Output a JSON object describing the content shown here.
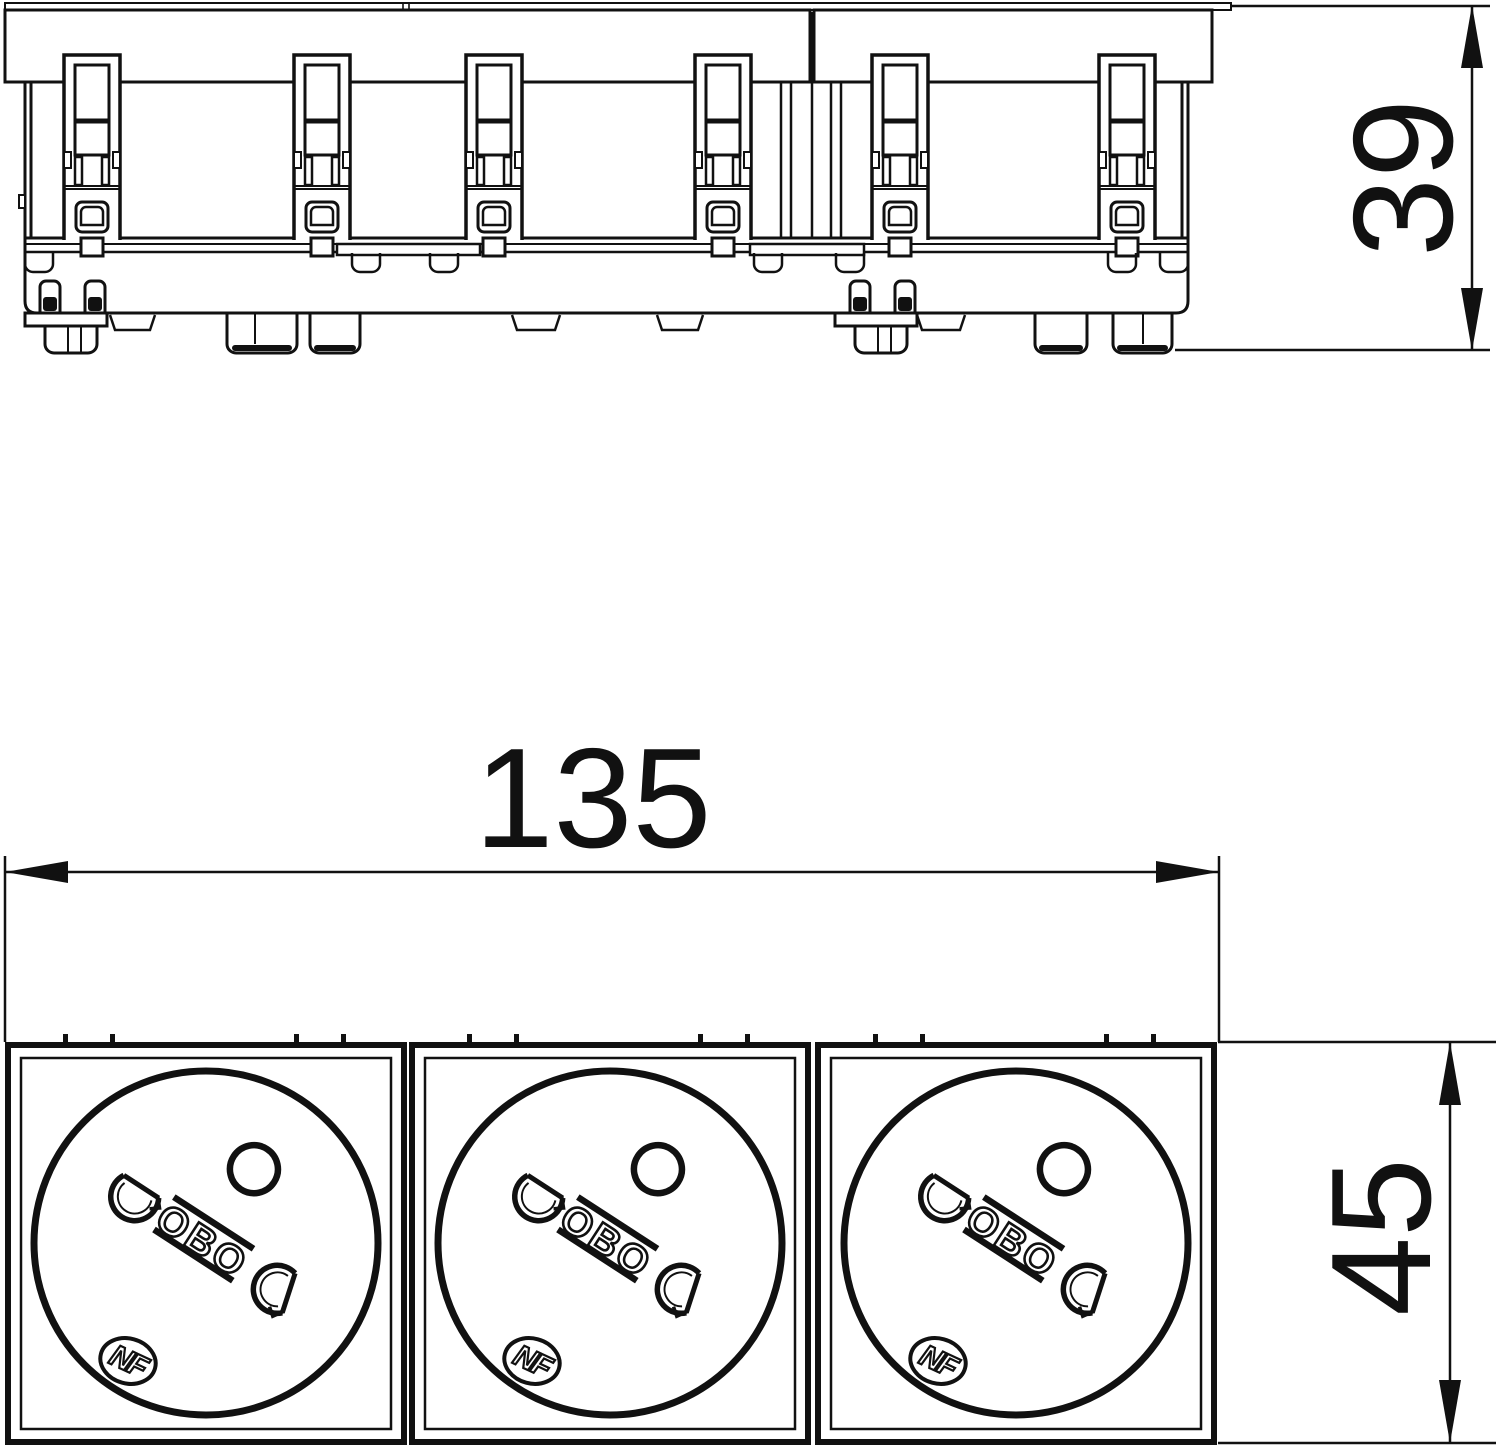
{
  "drawing": {
    "kind": "technical-dimension-drawing",
    "views": {
      "top_profile": "socket strip profile with mounting clips and fixing claws",
      "front": "three socket faces with earth pin and contact holes"
    }
  },
  "dimensions": {
    "width": {
      "label": "135"
    },
    "front_height": {
      "label": "45"
    },
    "depth": {
      "label": "39"
    }
  },
  "sockets": [
    {
      "brand": "OBO",
      "certification": "NF"
    },
    {
      "brand": "OBO",
      "certification": "NF"
    },
    {
      "brand": "OBO",
      "certification": "NF"
    }
  ],
  "colors": {
    "line": "#111111",
    "background": "#ffffff"
  }
}
